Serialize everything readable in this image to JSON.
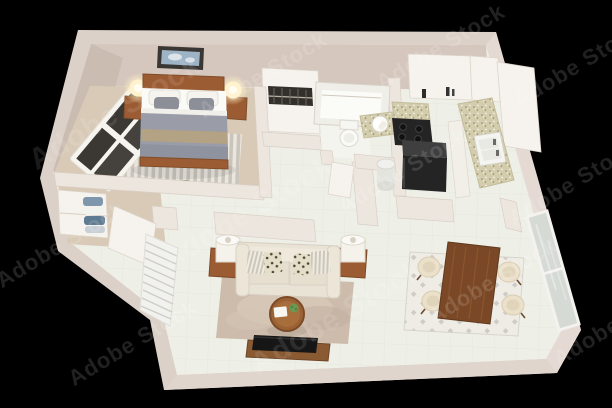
{
  "meta": {
    "kind": "3d-floor-plan-render",
    "view": "isometric-top-down",
    "width": 612,
    "height": 408,
    "background": "#000000"
  },
  "watermark": {
    "text": "Adobe Stock"
  },
  "colors": {
    "wall-top": "#dcd1c8",
    "wall-face": "#d6c7be",
    "wall-face-dark": "#cbbcb2",
    "wall-outer": "#e5dad3",
    "wall-bottom": "#e0d5cd",
    "wall-strip": "#ede6de",
    "wall-white": "#f6f3ee",
    "tile": "#eef0e8",
    "carpet": "#d8cab6",
    "rug-living": "#cdbcab",
    "rug-pale": "#f2efe9",
    "wood": "#8a5a33",
    "wood-dark": "#7a4826",
    "leather": "#9c5c33",
    "cream": "#e9e3d6",
    "duvet": "#9a9da8",
    "throw-tan": "#b3a283",
    "appliance": "#242424",
    "appliance-top": "#3f3f3f",
    "granite": "#d2ccab",
    "glass": "#d6dad5",
    "lamp-glow": "#ffefc4",
    "plant": "#6a9a52",
    "towel-blue": "#7e97ad",
    "art-blue": "#9db3c6",
    "frame-dark": "#3a3633",
    "white": "#fafaf7"
  },
  "scene": {
    "rooms": [
      {
        "name": "bedroom",
        "floor": "carpet",
        "items": [
          "double-bed",
          "brown-headboard",
          "gray-pillows",
          "gray-duvet",
          "tan-throw",
          "nightstand-left",
          "glowing-lamp-left",
          "nightstand-right",
          "glowing-lamp-right",
          "wall-art",
          "four-pane-window",
          "striped-rug",
          "closet-with-hanging-clothes"
        ]
      },
      {
        "name": "hallway",
        "floor": "carpet",
        "items": [
          "linen-closet",
          "folded-towels",
          "open-door"
        ]
      },
      {
        "name": "bathroom",
        "floor": "tile",
        "items": [
          "bathtub",
          "toilet",
          "granite-vanity-sink",
          "open-door",
          "water-heater"
        ]
      },
      {
        "name": "kitchen",
        "floor": "tile",
        "items": [
          "black-cooktop-stove",
          "black-refrigerator",
          "granite-counter",
          "double-sink",
          "upper-cabinets",
          "tall-pantry-cabinet"
        ]
      },
      {
        "name": "living-room",
        "floor": "tile",
        "items": [
          "cream-sofa",
          "striped-pillows",
          "leopard-pillows",
          "end-table-left",
          "drum-lamp-left",
          "end-table-right",
          "drum-lamp-right",
          "round-coffee-table",
          "book",
          "potted-plant",
          "area-rug",
          "tv",
          "tv-console",
          "diagonal-blinds-window"
        ]
      },
      {
        "name": "dining-area",
        "floor": "tile",
        "items": [
          "wood-dining-table",
          "cream-chairs-x4",
          "diamond-pattern-rug",
          "glass-door"
        ]
      }
    ]
  }
}
